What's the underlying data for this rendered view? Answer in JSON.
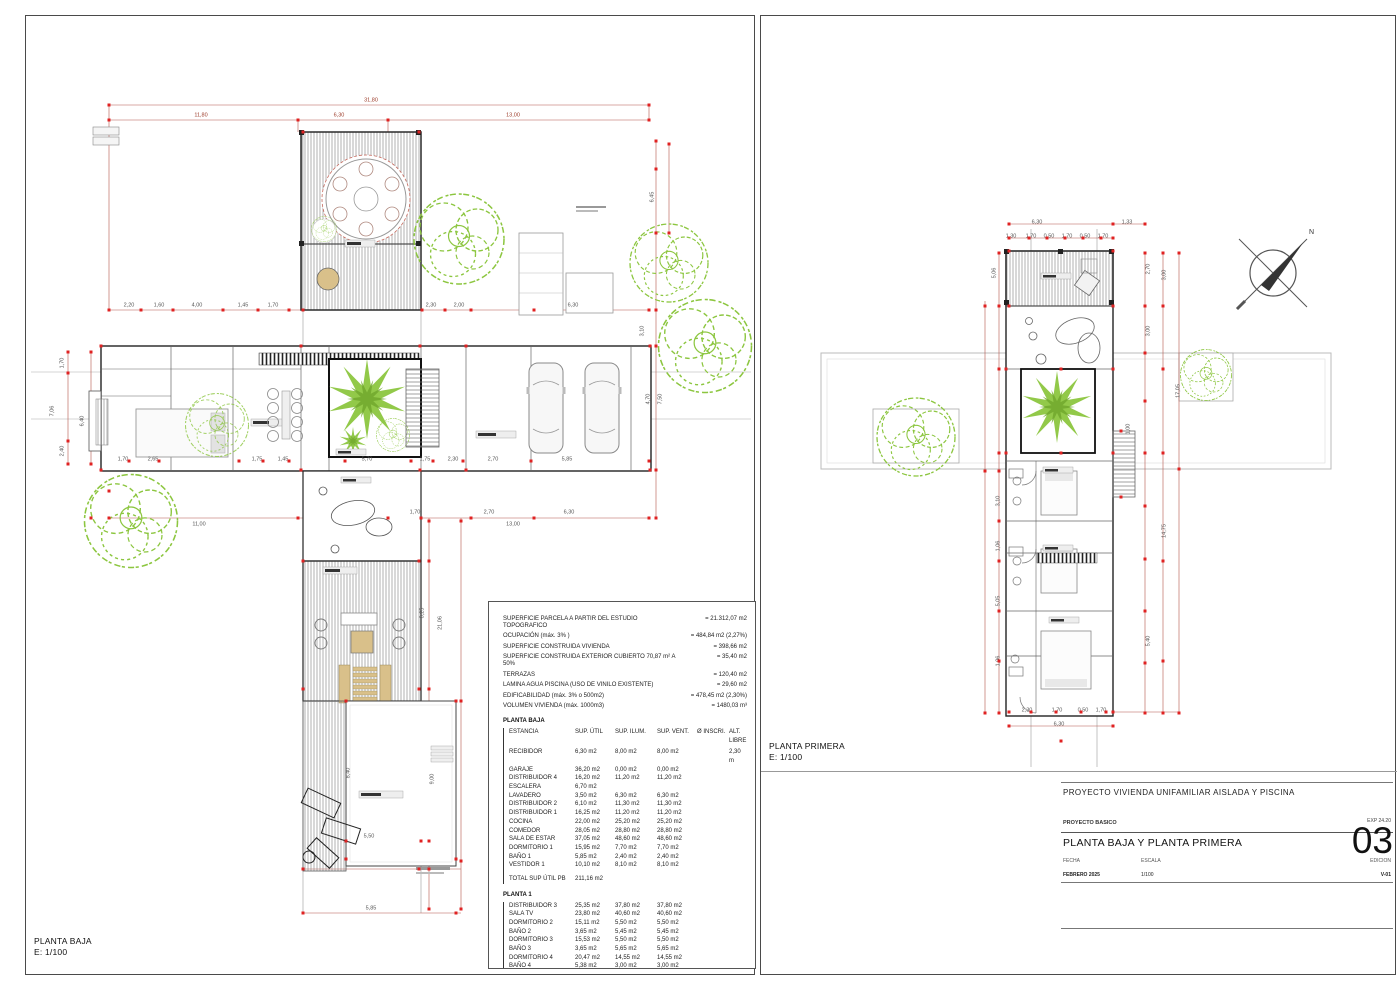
{
  "left_sheet": {
    "plan_label": "PLANTA BAJA",
    "plan_scale": "E: 1/100",
    "summary": {
      "rows": [
        {
          "label": "SUPERFICIE PARCELA A PARTIR DEL ESTUDIO TOPOGRAFICO",
          "value": "=  21.312,07  m2"
        },
        {
          "label": "OCUPACIÓN (máx. 3% )",
          "value": "= 484,84 m2 (2,27%)"
        },
        {
          "label": "SUPERFICIE CONSTRUIDA VIVIENDA",
          "value": "= 398,66 m2"
        },
        {
          "label": "SUPERFICIE CONSTRUIDA  EXTERIOR CUBIERTO   70,87 m² A 50%",
          "value": "= 35,40 m2"
        },
        {
          "label": "TERRAZAS",
          "value": "= 120,40 m2"
        },
        {
          "label": "LAMINA AGUA PISCINA (USO DE VINILO EXISTENTE)",
          "value": "= 29,60 m2"
        },
        {
          "label": "EDIFICABILIDAD (máx. 3% o 500m2)",
          "value": "= 478,45 m2 (2,30%)"
        },
        {
          "label": "VOLUMEN VIVIENDA (máx. 1000m3)",
          "value": "= 1480,03 m³"
        }
      ]
    },
    "planta_baja_table": {
      "title": "PLANTA BAJA",
      "columns": [
        "ESTANCIA",
        "SUP. ÚTIL",
        "SUP. ILUM.",
        "SUP. VENT.",
        "Ø INSCRI.",
        "ALT. LIBRE"
      ],
      "rows": [
        [
          "RECIBIDOR",
          "6,30 m2",
          "8,00 m2",
          "8,00 m2",
          "",
          "2,30 m"
        ],
        [
          "GARAJE",
          "36,20 m2",
          "0,00 m2",
          "0,00 m2",
          "",
          ""
        ],
        [
          "DISTRIBUIDOR 4",
          "16,20 m2",
          "11,20 m2",
          "11,20 m2",
          "",
          ""
        ],
        [
          "ESCALERA",
          "6,70 m2",
          "",
          "",
          "",
          ""
        ],
        [
          "LAVADERO",
          "3,50 m2",
          "6,30 m2",
          "6,30 m2",
          "",
          ""
        ],
        [
          "DISTRIBUIDOR 2",
          "6,10 m2",
          "11,30 m2",
          "11,30 m2",
          "",
          ""
        ],
        [
          "DISTRIBUIDOR 1",
          "16,25 m2",
          "11,20 m2",
          "11,20 m2",
          "",
          ""
        ],
        [
          "COCINA",
          "22,00 m2",
          "25,20 m2",
          "25,20 m2",
          "",
          ""
        ],
        [
          "COMEDOR",
          "28,05 m2",
          "28,80 m2",
          "28,80 m2",
          "",
          ""
        ],
        [
          "SALA DE ESTAR",
          "37,05 m2",
          "48,60 m2",
          "48,60 m2",
          "",
          ""
        ],
        [
          "DORMITORIO 1",
          "15,95 m2",
          "7,70 m2",
          "7,70 m2",
          "",
          ""
        ],
        [
          "BAÑO 1",
          "5,85 m2",
          "2,40 m2",
          "2,40 m2",
          "",
          ""
        ],
        [
          "VESTIDOR 1",
          "10,10 m2",
          "8,10 m2",
          "8,10 m2",
          "",
          ""
        ]
      ],
      "total_label": "TOTAL SUP ÚTIL PB",
      "total_value": "211,16 m2"
    },
    "planta_1_table": {
      "title": "PLANTA 1",
      "rows": [
        [
          "DISTRIBUIDOR 3",
          "25,35 m2",
          "37,80 m2",
          "37,80 m2"
        ],
        [
          "SALA TV",
          "23,80 m2",
          "40,60 m2",
          "40,60 m2"
        ],
        [
          "DORMITORIO 2",
          "15,11 m2",
          "5,50 m2",
          "5,50 m2"
        ],
        [
          "BAÑO 2",
          "3,65 m2",
          "5,45 m2",
          "5,45 m2"
        ],
        [
          "DORMITORIO 3",
          "15,53 m2",
          "5,50 m2",
          "5,50 m2"
        ],
        [
          "BAÑO 3",
          "3,65 m2",
          "5,65 m2",
          "5,65 m2"
        ],
        [
          "DORMITORIO 4",
          "20,47 m2",
          "14,55 m2",
          "14,55 m2"
        ],
        [
          "BAÑO 4",
          "5,38 m2",
          "3,00 m2",
          "3,00 m2"
        ]
      ],
      "total_label": "TOTAL SUP ÚTIL P1",
      "total_value": "111,14 m2",
      "grand_total": "TOTAL SUPERFICIE ÚTIL:  322,30 m2"
    },
    "dimensions": [
      {
        "t": "31,80",
        "x": 370,
        "y": 100,
        "red": 1
      },
      {
        "t": "11,80",
        "x": 200,
        "y": 115,
        "red": 1
      },
      {
        "t": "6,30",
        "x": 338,
        "y": 115,
        "red": 1
      },
      {
        "t": "13,00",
        "x": 512,
        "y": 115,
        "red": 1
      },
      {
        "t": "2,20",
        "x": 128,
        "y": 305
      },
      {
        "t": "1,60",
        "x": 158,
        "y": 305
      },
      {
        "t": "4,00",
        "x": 196,
        "y": 305
      },
      {
        "t": "1,45",
        "x": 242,
        "y": 305
      },
      {
        "t": "1,70",
        "x": 272,
        "y": 305
      },
      {
        "t": "2,30",
        "x": 430,
        "y": 305
      },
      {
        "t": "2,00",
        "x": 458,
        "y": 305
      },
      {
        "t": "6,30",
        "x": 572,
        "y": 305
      },
      {
        "t": "1,70",
        "x": 62,
        "y": 362,
        "rot": 1
      },
      {
        "t": "6,40",
        "x": 82,
        "y": 420,
        "rot": 1
      },
      {
        "t": "2,40",
        "x": 62,
        "y": 450,
        "rot": 1
      },
      {
        "t": "7,06",
        "x": 52,
        "y": 410,
        "rot": 1
      },
      {
        "t": "1,70",
        "x": 122,
        "y": 459
      },
      {
        "t": "2,65",
        "x": 152,
        "y": 459
      },
      {
        "t": "1,75",
        "x": 256,
        "y": 459
      },
      {
        "t": "1,45",
        "x": 282,
        "y": 459
      },
      {
        "t": "5,70",
        "x": 366,
        "y": 459
      },
      {
        "t": "1,75",
        "x": 424,
        "y": 459
      },
      {
        "t": "2,30",
        "x": 452,
        "y": 459
      },
      {
        "t": "2,70",
        "x": 492,
        "y": 459
      },
      {
        "t": "5,85",
        "x": 566,
        "y": 459
      },
      {
        "t": "11,00",
        "x": 198,
        "y": 524
      },
      {
        "t": "13,00",
        "x": 512,
        "y": 524
      },
      {
        "t": "1,70",
        "x": 414,
        "y": 512
      },
      {
        "t": "2,70",
        "x": 488,
        "y": 512
      },
      {
        "t": "6,30",
        "x": 568,
        "y": 512
      },
      {
        "t": "6,45",
        "x": 652,
        "y": 196,
        "rot": 1
      },
      {
        "t": "3,10",
        "x": 642,
        "y": 330,
        "rot": 1
      },
      {
        "t": "4,70",
        "x": 648,
        "y": 398,
        "rot": 1
      },
      {
        "t": "7,50",
        "x": 660,
        "y": 398,
        "rot": 1
      },
      {
        "t": "8,25",
        "x": 422,
        "y": 612,
        "rot": 1
      },
      {
        "t": "21,06",
        "x": 440,
        "y": 622,
        "rot": 1
      },
      {
        "t": "9,00",
        "x": 432,
        "y": 778,
        "rot": 1
      },
      {
        "t": "8,40",
        "x": 348,
        "y": 772,
        "rot": 1
      },
      {
        "t": "5,50",
        "x": 368,
        "y": 836
      },
      {
        "t": "5,85",
        "x": 370,
        "y": 908
      }
    ]
  },
  "right_sheet": {
    "plan_label": "PLANTA PRIMERA",
    "plan_scale": "E: 1/100",
    "north_label": "N",
    "dimensions": [
      {
        "t": "6,30",
        "x": 1036,
        "y": 222
      },
      {
        "t": "1,33",
        "x": 1126,
        "y": 222
      },
      {
        "t": "1,30",
        "x": 1010,
        "y": 236
      },
      {
        "t": "1,70",
        "x": 1030,
        "y": 236
      },
      {
        "t": "0,50",
        "x": 1048,
        "y": 236
      },
      {
        "t": "1,70",
        "x": 1066,
        "y": 236
      },
      {
        "t": "0,50",
        "x": 1084,
        "y": 236
      },
      {
        "t": "1,70",
        "x": 1102,
        "y": 236
      },
      {
        "t": "5,06",
        "x": 994,
        "y": 272,
        "rot": 1
      },
      {
        "t": "2,70",
        "x": 1148,
        "y": 268,
        "rot": 1
      },
      {
        "t": "3,00",
        "x": 1164,
        "y": 274,
        "rot": 1
      },
      {
        "t": "3,00",
        "x": 1148,
        "y": 330,
        "rot": 1
      },
      {
        "t": "17,05",
        "x": 1178,
        "y": 390,
        "rot": 1
      },
      {
        "t": "1,00",
        "x": 1128,
        "y": 428,
        "rot": 1
      },
      {
        "t": "3,10",
        "x": 998,
        "y": 500,
        "rot": 1
      },
      {
        "t": "1,06",
        "x": 998,
        "y": 545,
        "rot": 1
      },
      {
        "t": "5,05",
        "x": 998,
        "y": 600,
        "rot": 1
      },
      {
        "t": "1,06",
        "x": 998,
        "y": 660,
        "rot": 1
      },
      {
        "t": "14,75",
        "x": 1164,
        "y": 530,
        "rot": 1
      },
      {
        "t": "5,40",
        "x": 1148,
        "y": 640,
        "rot": 1
      },
      {
        "t": "2,30",
        "x": 1026,
        "y": 710
      },
      {
        "t": "1,70",
        "x": 1056,
        "y": 710
      },
      {
        "t": "0,50",
        "x": 1082,
        "y": 710
      },
      {
        "t": "1,70",
        "x": 1100,
        "y": 710
      },
      {
        "t": "6,30",
        "x": 1058,
        "y": 724
      }
    ],
    "titleblock": {
      "project_label": "PROYECTO  VIVIENDA UNIFAMILIAR AISLADA Y PISCINA",
      "phase": "PROYECTO BASICO",
      "exp": "EXP 24.20",
      "sheet_title": "PLANTA BAJA Y PLANTA PRIMERA",
      "sheet_number": "03",
      "fecha_label": "FECHA",
      "fecha_value": "FEBRERO 2025",
      "escala_label": "ESCALA",
      "escala_value": "1/100",
      "edicion_label": "EDICION",
      "edicion_value": "V-01"
    }
  },
  "colors": {
    "dimension_line": "#b5544a",
    "marker_red": "#e02222",
    "tree_green": "#8cc63f",
    "wall_black": "#222222",
    "wood_tan": "#d9c08a",
    "roof_band_gray": "#bbbbbb"
  }
}
